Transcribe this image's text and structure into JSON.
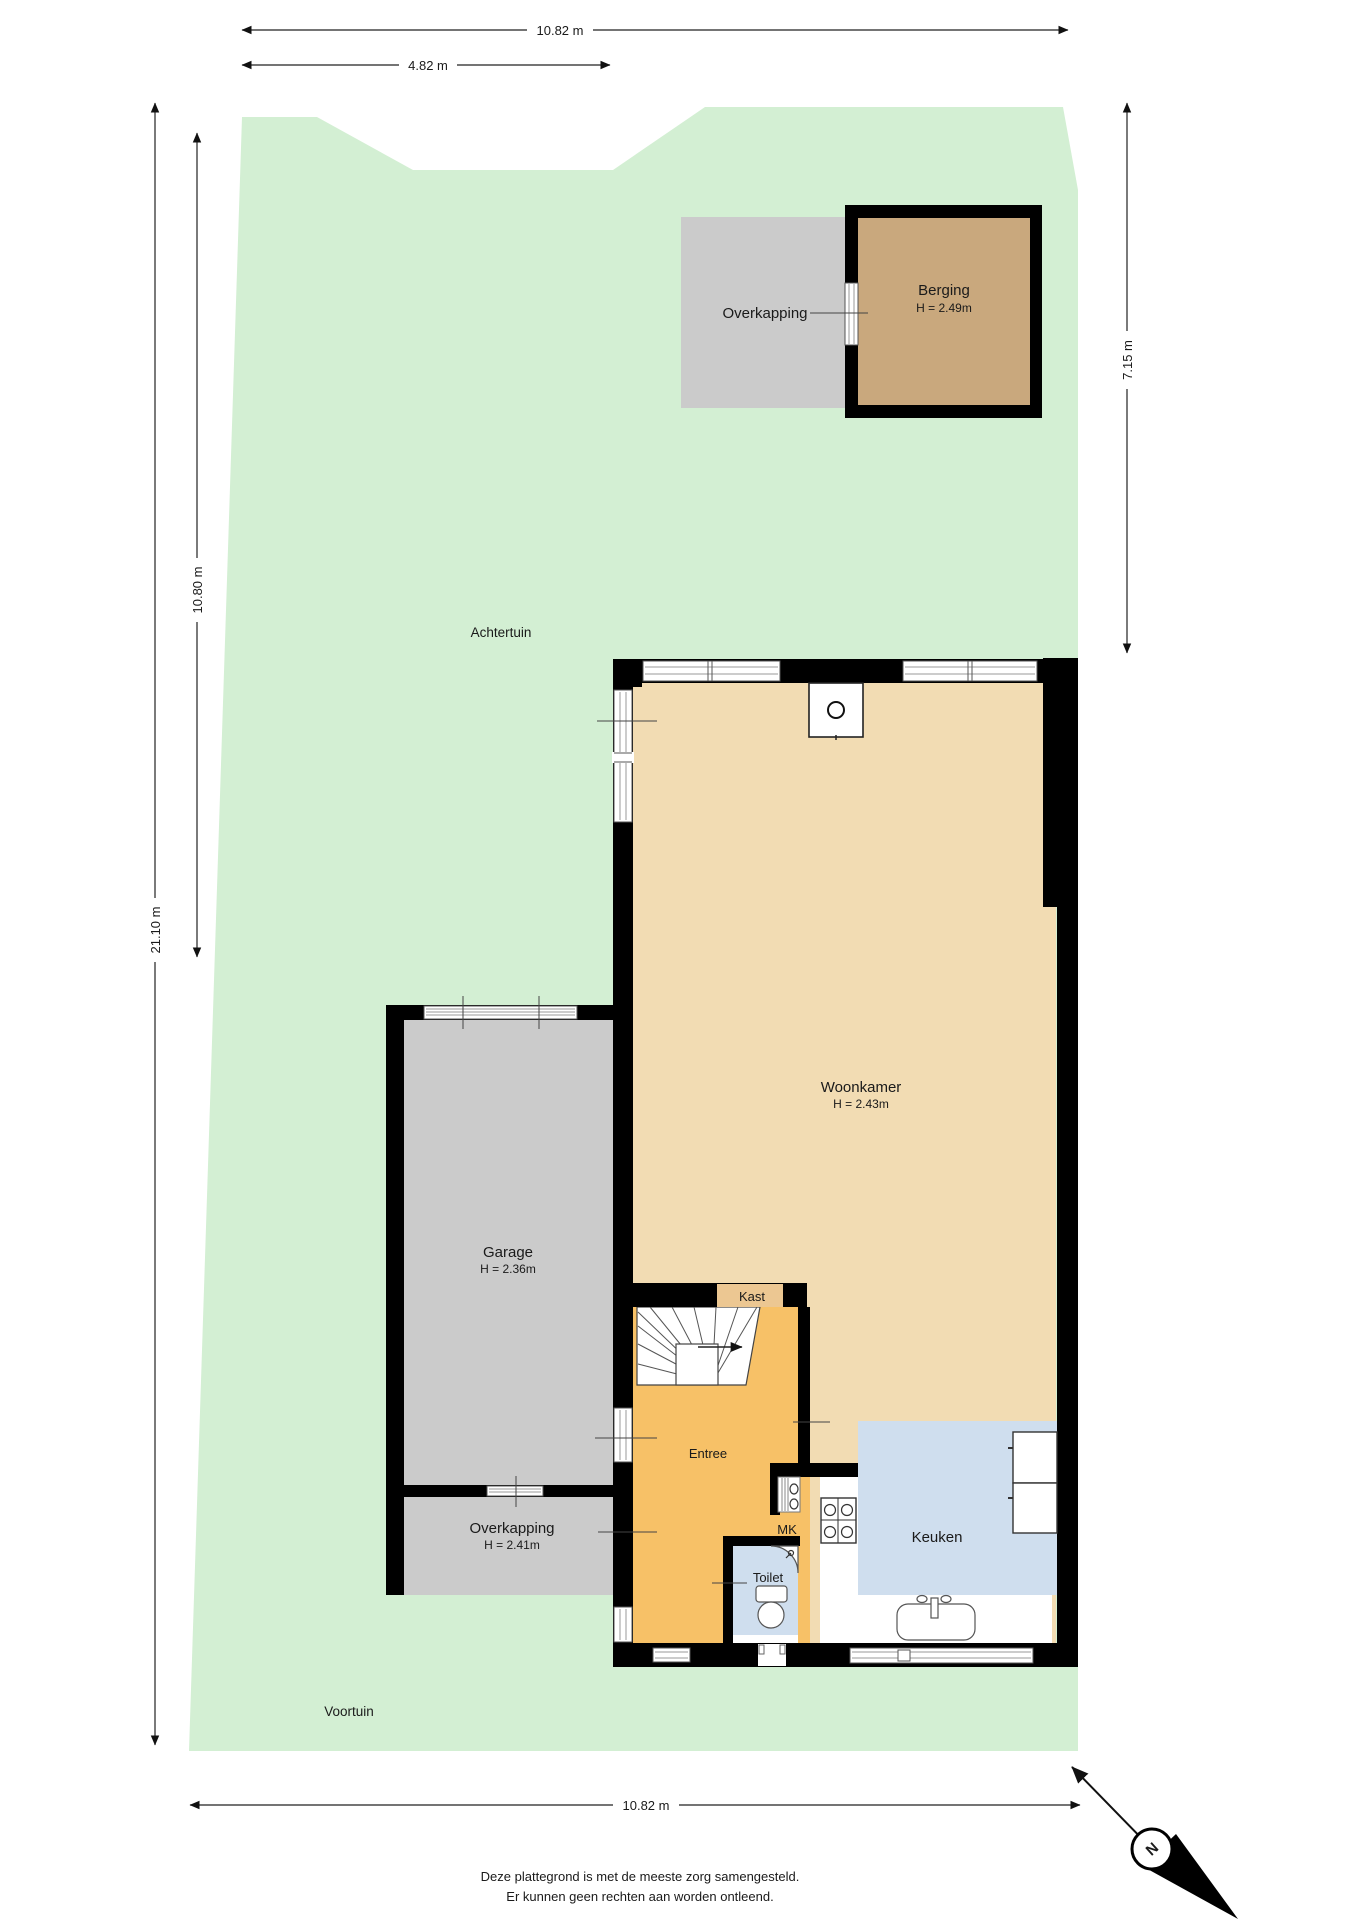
{
  "garden": {
    "back_label": "Achtertuin",
    "front_label": "Voortuin"
  },
  "rooms": {
    "overkapping_top": {
      "label": "Overkapping"
    },
    "berging": {
      "label": "Berging",
      "height": "H = 2.49m"
    },
    "woonkamer": {
      "label": "Woonkamer",
      "height": "H = 2.43m"
    },
    "garage": {
      "label": "Garage",
      "height": "H = 2.36m"
    },
    "overkapping_bottom": {
      "label": "Overkapping",
      "height": "H = 2.41m"
    },
    "entree": {
      "label": "Entree"
    },
    "kast": {
      "label": "Kast"
    },
    "mk": {
      "label": "MK"
    },
    "toilet": {
      "label": "Toilet"
    },
    "keuken": {
      "label": "Keuken"
    }
  },
  "dimensions": {
    "top_total": "10.82 m",
    "top_partial": "4.82 m",
    "left_total": "21.10 m",
    "left_back": "10.80 m",
    "right_back": "7.15 m",
    "bottom_total": "10.82 m"
  },
  "compass": {
    "north_label": "N"
  },
  "footer": {
    "line1": "Deze plattegrond is met de meeste zorg samengesteld.",
    "line2": "Er kunnen geen rechten aan worden ontleend."
  },
  "colors": {
    "garden": "#d3efd3",
    "living_floor": "#f2dcb3",
    "entry_floor": "#f7c167",
    "wet_room_floor": "#cfdeee",
    "storage_floor": "#c9a87d",
    "carport_floor": "#cbcbcb",
    "closet_floor": "#ecc792",
    "wall": "#000000"
  }
}
